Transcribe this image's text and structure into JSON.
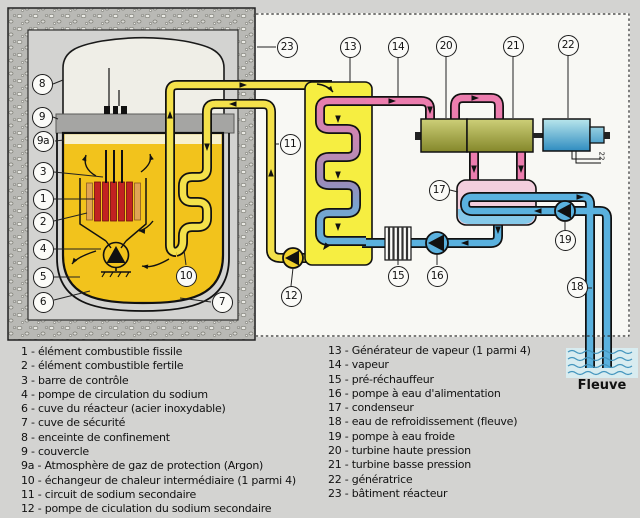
{
  "callouts": {
    "c1": "1",
    "c2": "2",
    "c3": "3",
    "c4": "4",
    "c5": "5",
    "c6": "6",
    "c7": "7",
    "c8": "8",
    "c9": "9",
    "c9a": "9a",
    "c10": "10",
    "c11": "11",
    "c12": "12",
    "c13": "13",
    "c14": "14",
    "c15": "15",
    "c16": "16",
    "c17": "17",
    "c18": "18",
    "c19": "19",
    "c20": "20",
    "c21": "21",
    "c22": "22",
    "c23": "23"
  },
  "power_line_label": "22",
  "river_label": "Fleuve",
  "legend": {
    "left": [
      "1 - élément combustible fissile",
      "2 - élément combustible fertile",
      "3 - barre de contrôle",
      "4 - pompe de circulation du sodium",
      "6 - cuve du réacteur (acier inoxydable)",
      "7 - cuve de sécurité",
      "8 - enceinte de confinement",
      "9 - couvercle",
      "9a - Atmosphère de gaz de protection (Argon)",
      "10 - échangeur de chaleur intermédiaire (1 parmi 4)",
      "11 - circuit de sodium secondaire",
      "12 - pompe de ciculation du sodium secondaire"
    ],
    "right": [
      "13 - Générateur de vapeur (1 parmi 4)",
      "14 - vapeur",
      "15 - pré-réchauffeur",
      "16 - pompe à eau d'alimentation",
      "17 - condenseur",
      "18 - eau de refroidissement (fleuve)",
      "19 - pompe à eau froide",
      "20 - turbine haute pression",
      "21 - turbine basse pression",
      "22 - génératrice",
      "23 - bâtiment réacteur"
    ]
  },
  "colors": {
    "background": "#d3d3d1",
    "paper_white": "#f8f8f4",
    "concrete": "#b9b9b5",
    "sodium_pool": "#f2c31c",
    "sodium_pipe": "#f4e14b",
    "steam_generator": "#f6ee41",
    "steam_pink": "#ec7dae",
    "water_blue": "#5ab1de",
    "turbine_olive": "#a8aa4a",
    "generator_cyan": "#5fb9d4",
    "condenser_pink": "#f3cedd",
    "fuel_fissile": "#c22222",
    "fuel_fertile": "#e0a355",
    "river_wave": "#4596be"
  }
}
